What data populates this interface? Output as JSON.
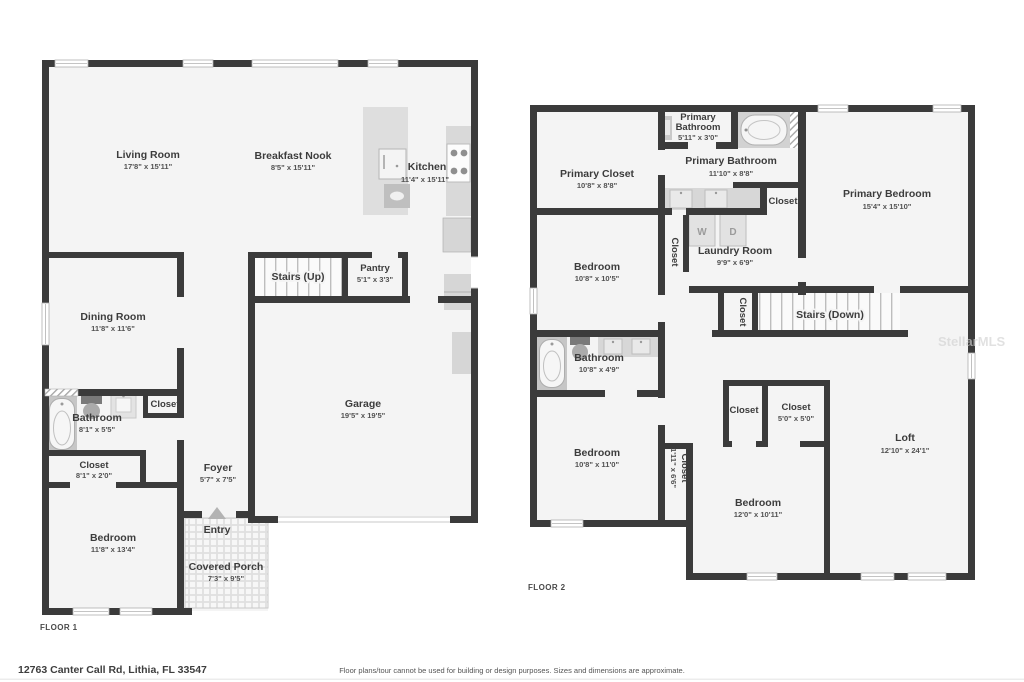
{
  "page": {
    "address": "12763 Canter Call Rd, Lithia, FL 33547",
    "disclaimer": "Floor plans/tour cannot be used for building or design purposes. Sizes and dimensions are approximate.",
    "watermark": "StellarMLS"
  },
  "colors": {
    "wall": "#3b3b3b",
    "floor": "#f4f4f4",
    "fixture": "#d6d6d6",
    "text": "#3c3c3c"
  },
  "floor1": {
    "label": "FLOOR 1",
    "rooms": {
      "living_room": {
        "name": "Living Room",
        "dims": "17'8\" x 15'11\""
      },
      "breakfast_nook": {
        "name": "Breakfast Nook",
        "dims": "8'5\" x 15'11\""
      },
      "kitchen": {
        "name": "Kitchen",
        "dims": "11'4\" x 15'11\""
      },
      "stairs_up": {
        "name": "Stairs (Up)"
      },
      "pantry": {
        "name": "Pantry",
        "dims": "5'1\" x 3'3\""
      },
      "dining_room": {
        "name": "Dining Room",
        "dims": "11'8\" x 11'6\""
      },
      "garage": {
        "name": "Garage",
        "dims": "19'5\" x 19'5\""
      },
      "bathroom": {
        "name": "Bathroom",
        "dims": "8'1\" x 5'5\""
      },
      "closet_hall": {
        "name": "Closet"
      },
      "closet_bedroom": {
        "name": "Closet",
        "dims": "8'1\" x 2'0\""
      },
      "bedroom": {
        "name": "Bedroom",
        "dims": "11'8\" x 13'4\""
      },
      "foyer": {
        "name": "Foyer",
        "dims": "5'7\" x 7'5\""
      },
      "entry": {
        "name": "Entry"
      },
      "covered_porch": {
        "name": "Covered Porch",
        "dims": "7'3\" x 9'5\""
      }
    }
  },
  "floor2": {
    "label": "FLOOR 2",
    "appliances": {
      "washer": "W",
      "dryer": "D"
    },
    "rooms": {
      "primary_closet": {
        "name": "Primary Closet",
        "dims": "10'8\" x 8'8\""
      },
      "primary_bathroom_small": {
        "name_line1": "Primary",
        "name_line2": "Bathroom",
        "dims": "5'11\" x 3'0\""
      },
      "primary_bathroom": {
        "name": "Primary Bathroom",
        "dims": "11'10\" x 8'8\""
      },
      "water_closet": {
        "name": "Closet"
      },
      "primary_bedroom": {
        "name": "Primary Bedroom",
        "dims": "15'4\" x 15'10\""
      },
      "bedroom_upper": {
        "name": "Bedroom",
        "dims": "10'8\" x 10'5\""
      },
      "hall_closet": {
        "name": "Closet"
      },
      "laundry_room": {
        "name": "Laundry Room",
        "dims": "9'9\" x 6'9\""
      },
      "stairs_closet": {
        "name": "Closet"
      },
      "stairs_down": {
        "name": "Stairs (Down)"
      },
      "bathroom": {
        "name": "Bathroom",
        "dims": "10'8\" x 4'9\""
      },
      "bedroom_middle": {
        "name": "Bedroom",
        "dims": "10'8\" x 11'0\""
      },
      "hall_closet_narrow": {
        "name": "Closet",
        "dims": "1'11\" x 6'6\""
      },
      "closet_small": {
        "name": "Closet"
      },
      "closet_5x5": {
        "name": "Closet",
        "dims": "5'0\" x 5'0\""
      },
      "bedroom_bottom": {
        "name": "Bedroom",
        "dims": "12'0\" x 10'11\""
      },
      "loft": {
        "name": "Loft",
        "dims": "12'10\" x 24'1\""
      }
    }
  }
}
